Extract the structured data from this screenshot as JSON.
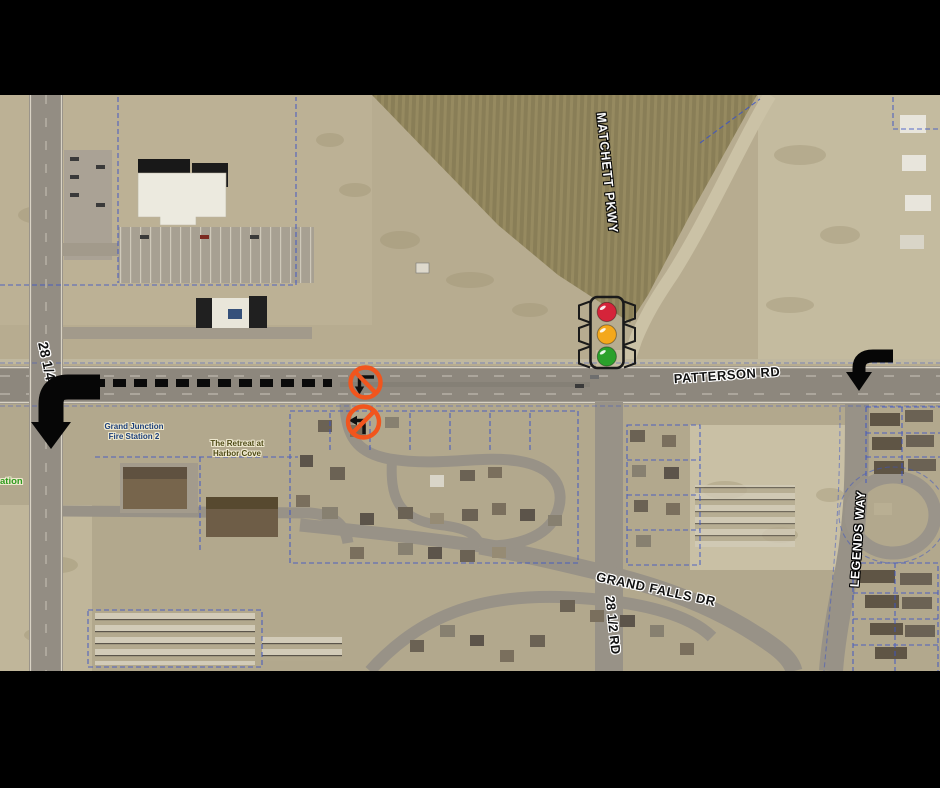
{
  "frame": {
    "background": "#000000"
  },
  "map": {
    "road_labels": {
      "matchett_pkwy": "MATCHETT PKWY",
      "patterson_rd": "PATTERSON RD",
      "road_28_quarter": "28 1/4",
      "road_28_half": "28 1/2 RD",
      "grand_falls_dr": "GRAND FALLS DR",
      "legends_way": "LEGENDS WAY"
    },
    "place_labels": {
      "fire_station": {
        "line1": "Grand Junction",
        "line2": "Fire Station 2",
        "color": "#1C3F7A"
      },
      "harbor_cove": {
        "line1": "The Retreat at",
        "line2": "Harbor Cove",
        "color": "#4E4A16"
      },
      "edge_partial": {
        "text": "ation",
        "color": "#2E9B1E"
      }
    },
    "annotations": {
      "traffic_signal": {
        "red": "#D5243A",
        "yellow": "#F4A81C",
        "green": "#2BA12B",
        "housing": "#1A1A1A"
      },
      "no_left_turn_color": "#F1551D",
      "turn_arrow_color": "#060606",
      "parcel_line_color": "#3B54C7"
    }
  }
}
